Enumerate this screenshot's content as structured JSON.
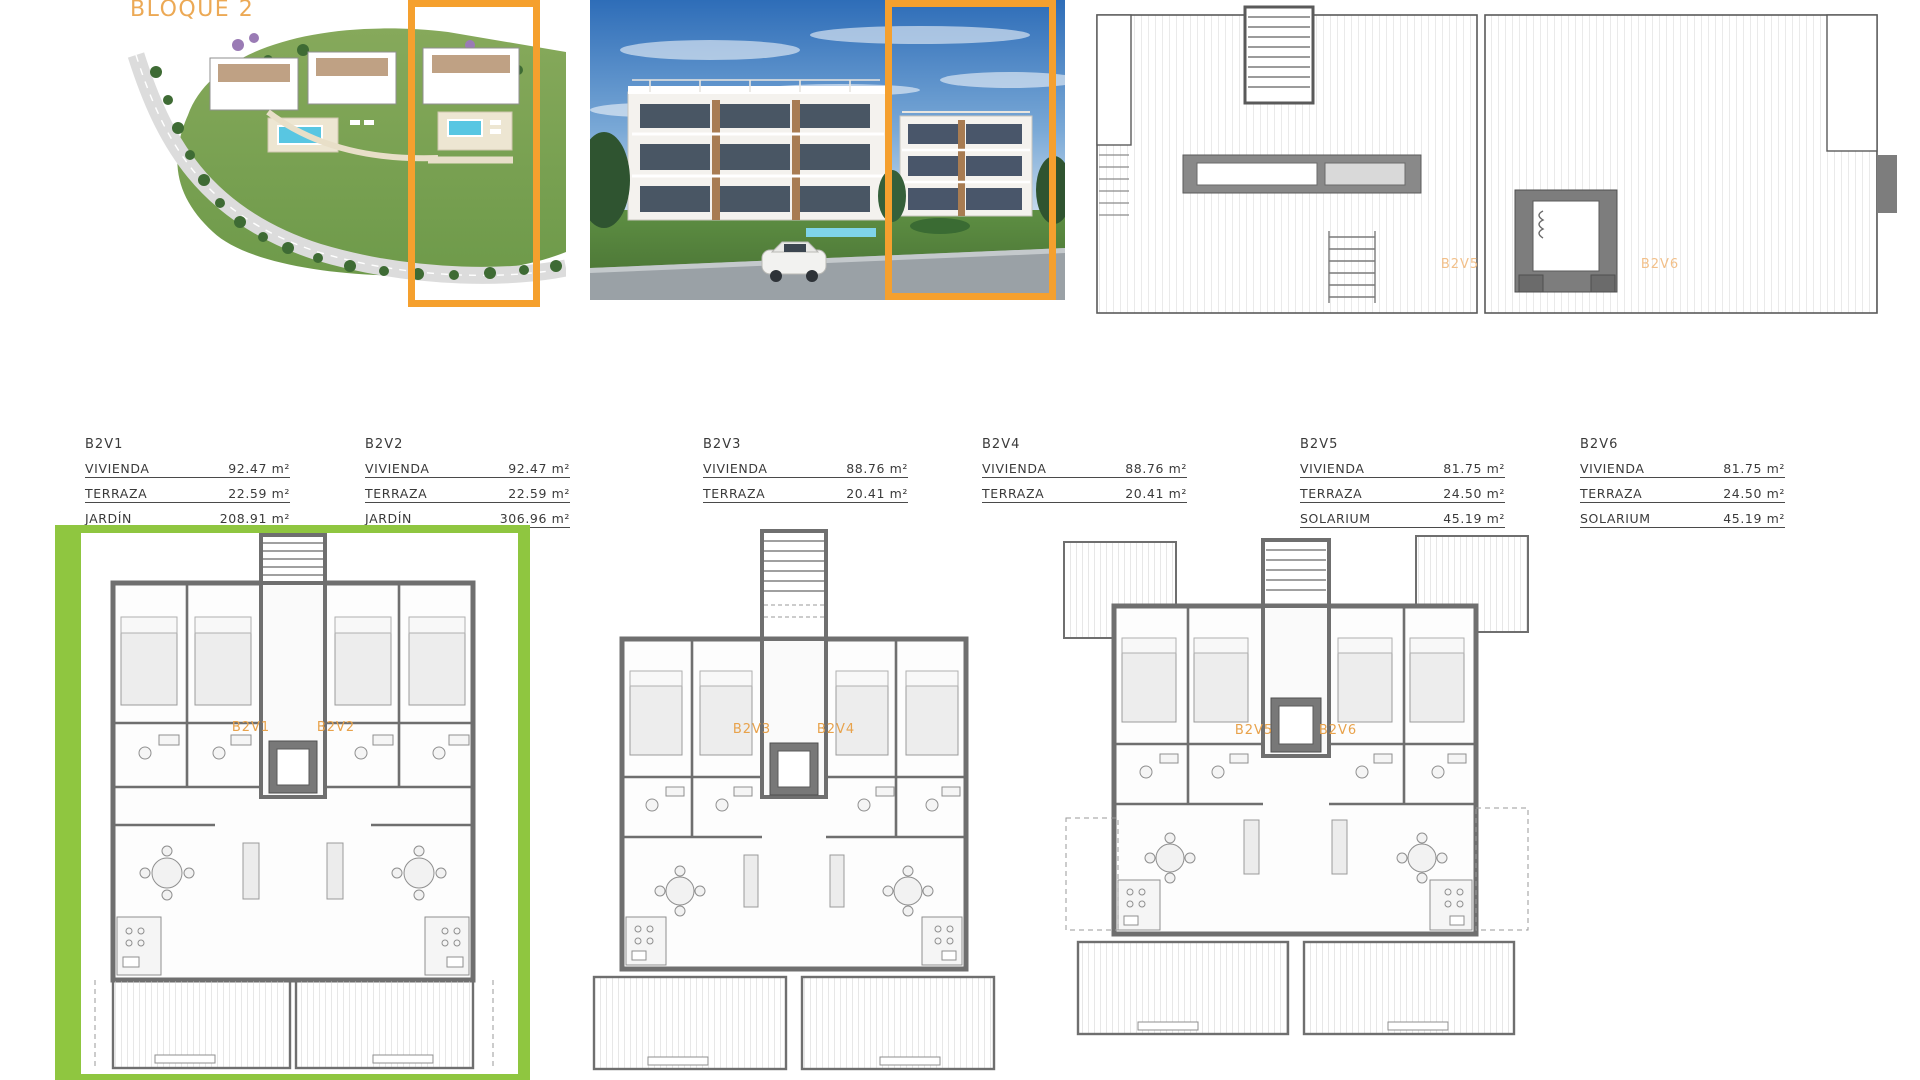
{
  "title": "BLOQUE 2",
  "colors": {
    "accent_orange": "#F5A02E",
    "title_orange": "#ECA955",
    "plan_label_orange": "#E8A24B",
    "garden_green": "#8FC640"
  },
  "units": [
    {
      "id": "B2V1",
      "rows": [
        {
          "label": "VIVIENDA",
          "value": "92.47 m²"
        },
        {
          "label": "TERRAZA",
          "value": "22.59 m²"
        },
        {
          "label": "JARDÍN",
          "value": "208.91 m²"
        }
      ]
    },
    {
      "id": "B2V2",
      "rows": [
        {
          "label": "VIVIENDA",
          "value": "92.47 m²"
        },
        {
          "label": "TERRAZA",
          "value": "22.59 m²"
        },
        {
          "label": "JARDÍN",
          "value": "306.96 m²"
        }
      ]
    },
    {
      "id": "B2V3",
      "rows": [
        {
          "label": "VIVIENDA",
          "value": "88.76 m²"
        },
        {
          "label": "TERRAZA",
          "value": "20.41 m²"
        }
      ]
    },
    {
      "id": "B2V4",
      "rows": [
        {
          "label": "VIVIENDA",
          "value": "88.76 m²"
        },
        {
          "label": "TERRAZA",
          "value": "20.41 m²"
        }
      ]
    },
    {
      "id": "B2V5",
      "rows": [
        {
          "label": "VIVIENDA",
          "value": "81.75 m²"
        },
        {
          "label": "TERRAZA",
          "value": "24.50 m²"
        },
        {
          "label": "SOLARIUM",
          "value": "45.19 m²"
        }
      ]
    },
    {
      "id": "B2V6",
      "rows": [
        {
          "label": "VIVIENDA",
          "value": "81.75 m²"
        },
        {
          "label": "TERRAZA",
          "value": "24.50 m²"
        },
        {
          "label": "SOLARIUM",
          "value": "45.19 m²"
        }
      ]
    }
  ],
  "plan_labels": {
    "roof": [
      "B2V5",
      "B2V6"
    ],
    "ground": [
      "B2V1",
      "B2V2"
    ],
    "first": [
      "B2V3",
      "B2V4"
    ],
    "second": [
      "B2V5",
      "B2V6"
    ]
  }
}
